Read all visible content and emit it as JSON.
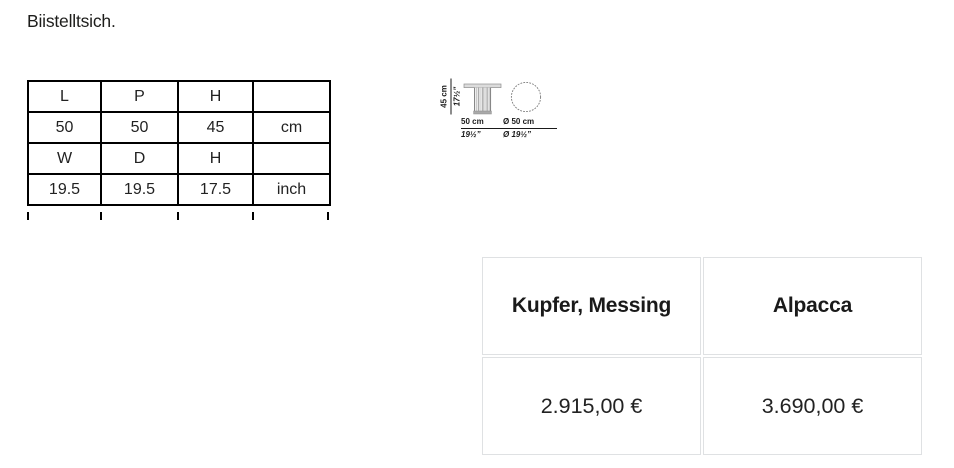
{
  "title": "Biistelltsich.",
  "dimensions_table": {
    "rows": [
      [
        "L",
        "P",
        "H",
        ""
      ],
      [
        "50",
        "50",
        "45",
        "cm"
      ],
      [
        "W",
        "D",
        "H",
        ""
      ],
      [
        "19.5",
        "19.5",
        "17.5",
        "inch"
      ]
    ]
  },
  "drawing": {
    "height_cm": "45 cm",
    "height_in": "17½”",
    "width_cm": "50 cm",
    "width_in": "19½”",
    "dia_cm": "Ø 50 cm",
    "dia_in": "Ø 19½”"
  },
  "price_table": {
    "columns": [
      {
        "material": "Kupfer, Messing",
        "price": "2.915,00 €"
      },
      {
        "material": "Alpacca",
        "price": "3.690,00 €"
      }
    ]
  },
  "colors": {
    "text": "#1a1a1a",
    "dims_border": "#000000",
    "price_border": "#dfe1e3"
  }
}
